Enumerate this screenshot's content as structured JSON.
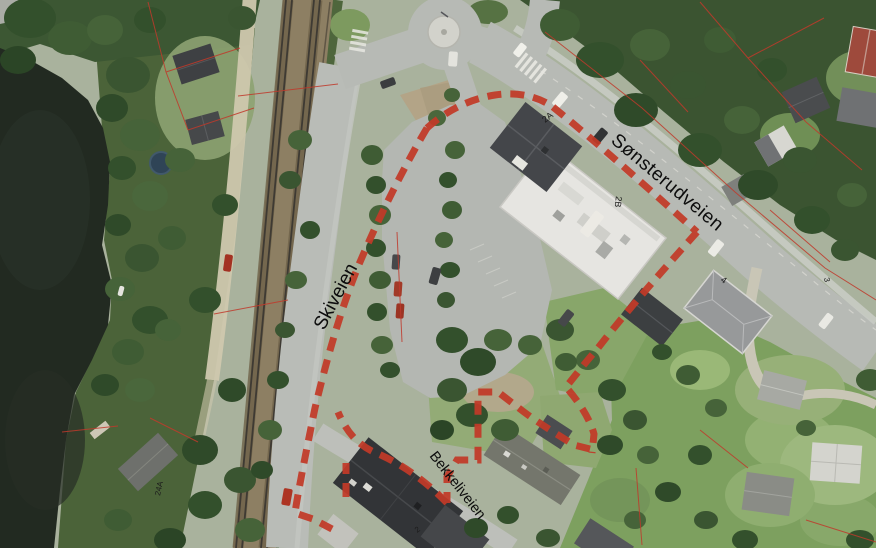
{
  "labels": {
    "roads": [
      {
        "id": "skiveien",
        "text": "Skiveien"
      },
      {
        "id": "sonsterudveien",
        "text": "Sønsterudveien"
      },
      {
        "id": "bekkeliveien",
        "text": "Bekkeliveien"
      }
    ],
    "addresses": [
      {
        "id": "h2a",
        "text": "2A"
      },
      {
        "id": "h2b",
        "text": "2B"
      },
      {
        "id": "h4",
        "text": "4"
      },
      {
        "id": "h3",
        "text": "3"
      },
      {
        "id": "h24a",
        "text": "24A"
      },
      {
        "id": "h2",
        "text": "2"
      }
    ]
  },
  "colors": {
    "boundary_dash_red": "#c23a28",
    "property_line_red": "#c0392b",
    "water_dark": "#222a21",
    "forest_green": "#3b5431",
    "lawn_green": "#7da05f",
    "road_gray": "#b7bab5",
    "rail_bed_brown": "#8d7f63",
    "building_roof_white": "#e6e5e1",
    "label_black": "#0d0d0d"
  }
}
